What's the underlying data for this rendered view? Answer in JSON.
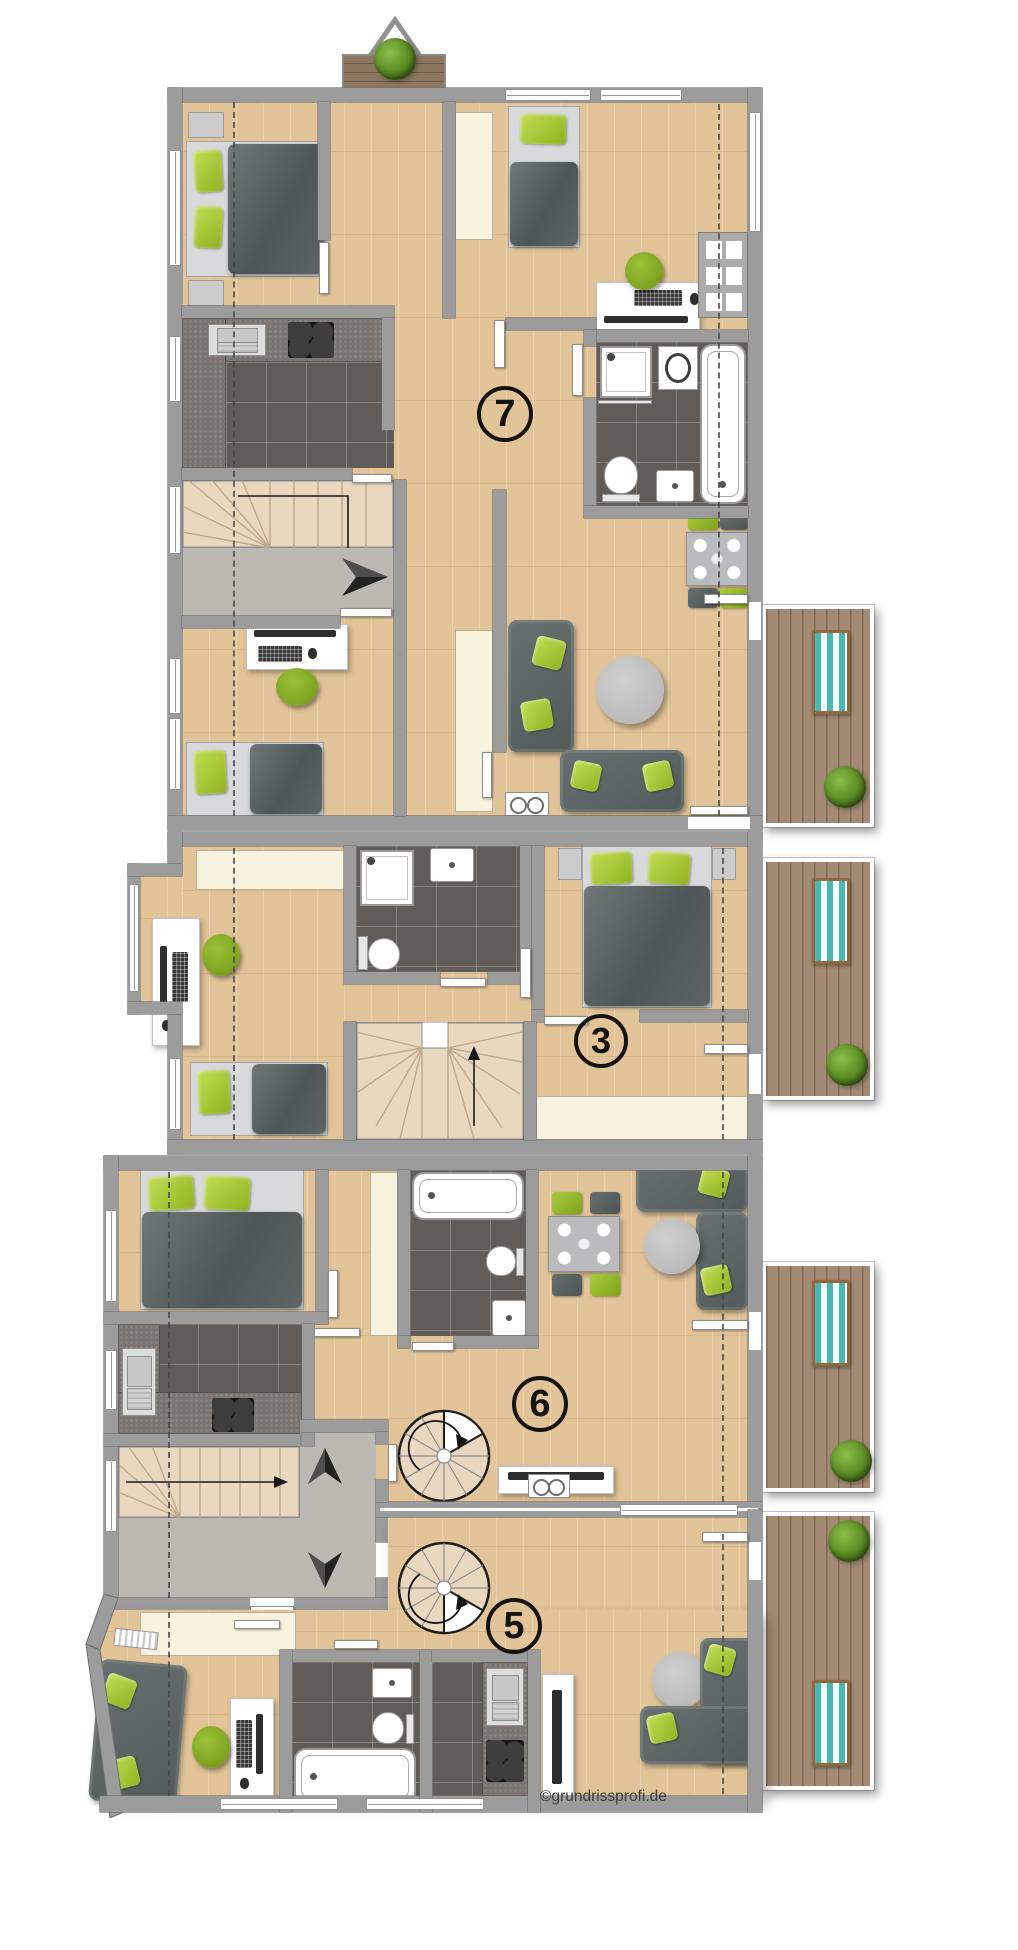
{
  "watermark": {
    "text": "©grundrissprofi.de"
  },
  "units": [
    {
      "id": "unit-7",
      "label": "7"
    },
    {
      "id": "unit-3",
      "label": "3"
    },
    {
      "id": "unit-6",
      "label": "6"
    },
    {
      "id": "unit-5",
      "label": "5"
    }
  ],
  "colors": {
    "wall": "#9c9c9c",
    "wallEdge": "#6f6f6f",
    "wood": "#e2c498",
    "tile": "#615c57",
    "counter": "#7a7571",
    "stair": "#ead7c0",
    "stairEdge": "#bfa98c",
    "landing": "#bcb8b2",
    "cream": "#f8f3de",
    "green": "#8fb321",
    "sofa": "#5d6466",
    "deck": "#a28a74",
    "deckTeal": "#4ab7b5",
    "labelInk": "#141414",
    "watermarkInk": "#3d3d3d"
  }
}
